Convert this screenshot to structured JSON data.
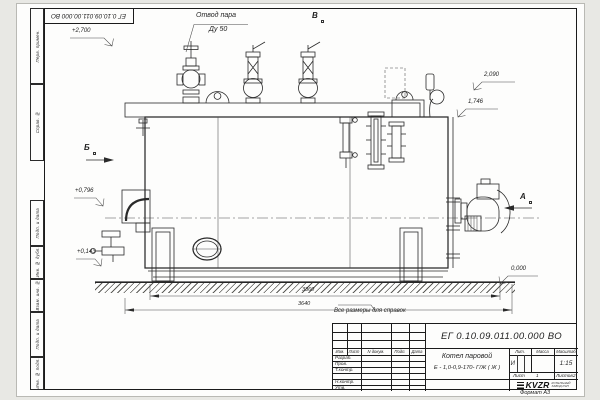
{
  "sheet": {
    "stamp": "ЕГ 0.10.09.011.00.000  ВО",
    "reference_note": "Все размеры для справок",
    "format_note": "Формат А3",
    "margin_columns": [
      "Перв. примен.",
      "Справ. №",
      "Подп. и дата",
      "Инв. № дубл.",
      "Взам. инв. №",
      "Подп. и дата",
      "Инв. № подл."
    ]
  },
  "view": {
    "callout_line1": "Отвод пара",
    "callout_line2": "Ду 50",
    "label_b": "Б",
    "label_v": "В",
    "label_a": "А",
    "elev_2700": "+2,700",
    "elev_2090": "2,090",
    "elev_1746": "1,746",
    "elev_0796": "+0,796",
    "elev_0143": "+0,143",
    "elev_0000": "0,000",
    "dim_3360": "3360",
    "dim_3640": "3640"
  },
  "tb": {
    "doc_number": "ЕГ 0.10.09.011.00.000  ВО",
    "name_line1": "Котел паровой",
    "name_line2": "Е - 1,0-0,9-170- Г/Ж ( Ж )",
    "col_izm": "Изм.",
    "col_list": "Лист",
    "col_doc": "N докум.",
    "col_podp": "Подп.",
    "col_data": "Дата",
    "row_razrab": "Разраб.",
    "row_prov": "Пров.",
    "row_tkontr": "Т.контр.",
    "row_nkontr": "Н.контр.",
    "row_utv": "Утв.",
    "lit_header": "Лит.",
    "mass_header": "Масса",
    "scale_header": "Масштаб",
    "lit_value": "И",
    "scale_value": "1:15",
    "list_label": "Лист",
    "list_value": "1",
    "listov_label": "Листов",
    "listov_value": "2",
    "logo_text": "KVZR",
    "logo_sub1": "КОТЕЛЬНЫЙ",
    "logo_sub2": "ЗАВОД РЭП"
  }
}
